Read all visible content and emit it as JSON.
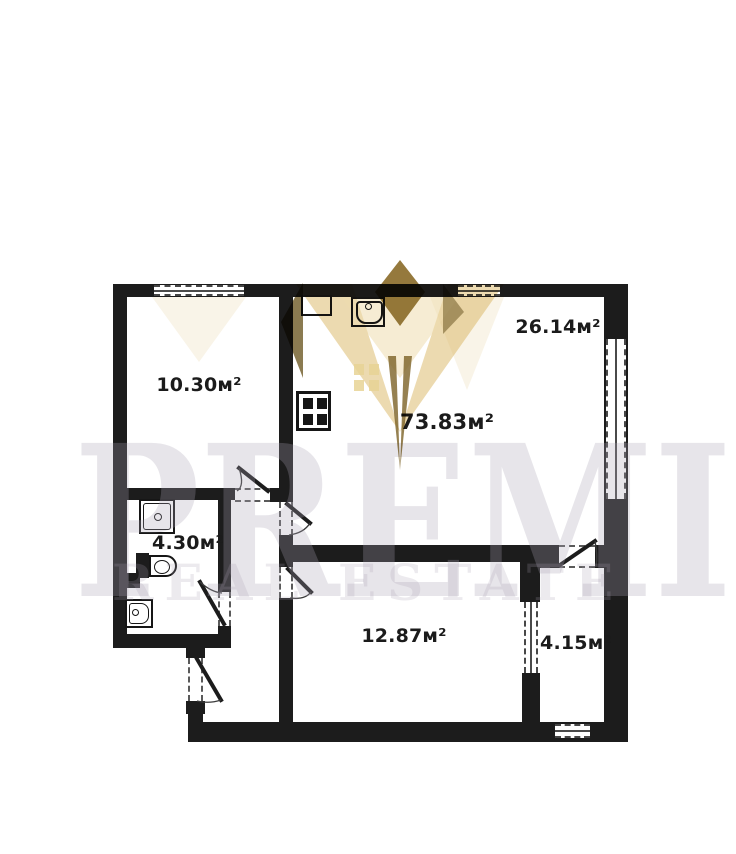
{
  "watermark": {
    "brand": "PREMIER",
    "tagline": "REAL ESTATE"
  },
  "rooms": [
    {
      "label": "10.30м²"
    },
    {
      "label": "26.14м²"
    },
    {
      "label": "73.83м²"
    },
    {
      "label": "4.30м²"
    },
    {
      "label": "12.87м²"
    },
    {
      "label": "4.15м²"
    }
  ],
  "icons": {
    "kitchen_sink": "kitchen-sink-icon",
    "vent_shaft": "vent-shaft-box",
    "stove": "stove-icon",
    "shower": "shower-tray-icon",
    "toilet": "toilet-icon",
    "washbasin": "washbasin-icon"
  },
  "colors": {
    "wall": "#1c1c1c",
    "label_text": "#1b1b1b",
    "watermark_text": "#e9e6ec",
    "crown_gold": "#d9b662",
    "crown_dark": "#6e5a26",
    "crown_pale": "#f3e9d2"
  }
}
